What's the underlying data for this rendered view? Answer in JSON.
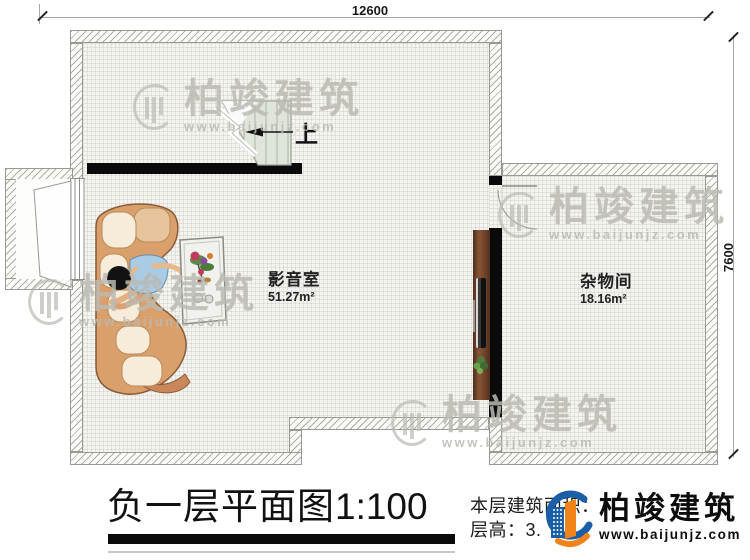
{
  "drawing": {
    "title": "负一层平面图",
    "scale": "1:100",
    "dimensions": {
      "width_mm": "12600",
      "height_mm": "7600"
    },
    "rooms": [
      {
        "name": "影音室",
        "area": "51.27m²"
      },
      {
        "name": "杂物间",
        "area": "18.16m²"
      }
    ],
    "stair_label": "上",
    "info": {
      "area_label": "本层建筑面积：",
      "floor_height_label": "层高：3."
    }
  },
  "brand": {
    "name": "柏竣建筑",
    "website": "www.baijunjz.com"
  },
  "watermark": {
    "text": "柏竣建筑",
    "url": "www.baijunjz.com"
  },
  "colors": {
    "logo_blue": "#1b5ea8",
    "logo_orange": "#f08419",
    "wall_black": "#0a0a0a",
    "wood_panel": "#6b3f28",
    "sofa": "#d9a06b",
    "stair": "#e0e5dc"
  }
}
